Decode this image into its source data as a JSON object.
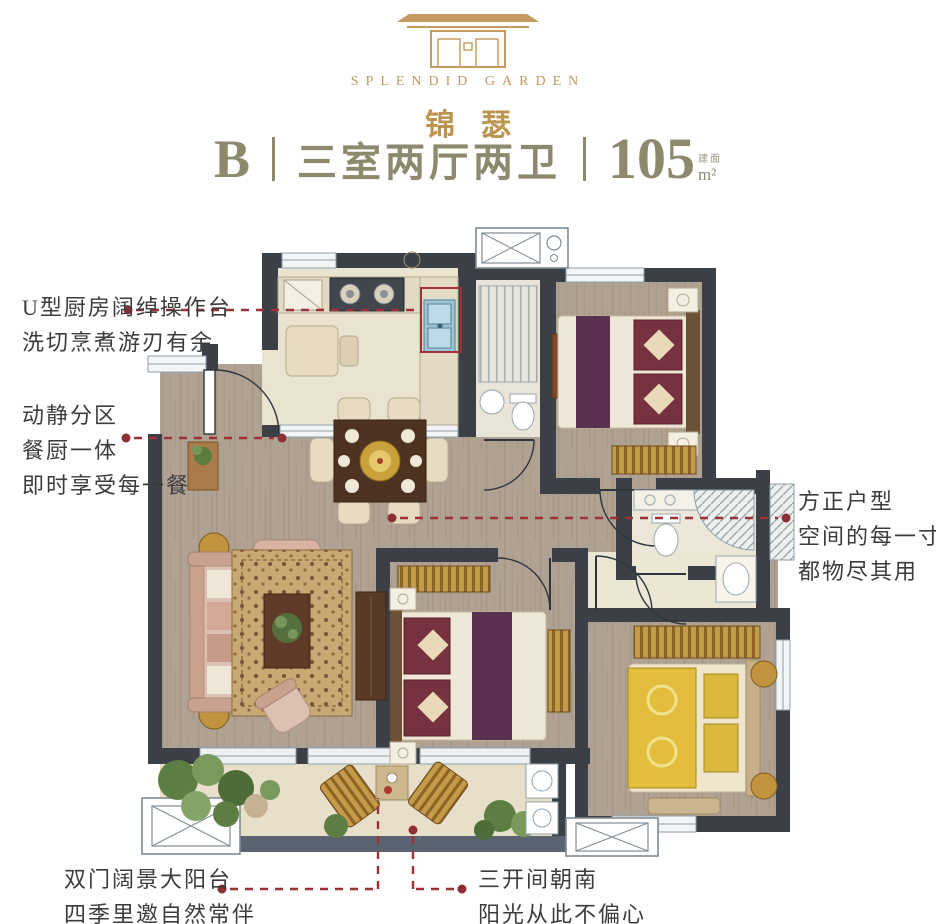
{
  "logo": {
    "brand_en": "SPLENDID GARDEN",
    "brand_cn": "锦瑟"
  },
  "title": {
    "unit": "B",
    "sep": "|",
    "layout": "三室两厅两卫",
    "area": "105",
    "area_prefix": "建面",
    "area_unit": "m²"
  },
  "annotations": {
    "kitchen": {
      "line1": "U型厨房阔绰操作台",
      "line2": "洗切烹煮游刃有余"
    },
    "zoning": {
      "line1": "动静分区",
      "line2": "餐厨一体",
      "line3": "即时享受每一餐"
    },
    "square": {
      "line1": "方正户型",
      "line2": "空间的每一寸",
      "line3": "都物尽其用"
    },
    "balcony": {
      "line1": "双门阔景大阳台",
      "line2": "四季里邀自然常伴"
    },
    "south": {
      "line1": "三开间朝南",
      "line2": "阳光从此不偏心"
    }
  },
  "colors": {
    "brand_gold": "#c09a5e",
    "title_text": "#8d896c",
    "annotation_text": "#3c3c3c",
    "annotation_red": "#9c3137",
    "wall": "#3a4046"
  }
}
